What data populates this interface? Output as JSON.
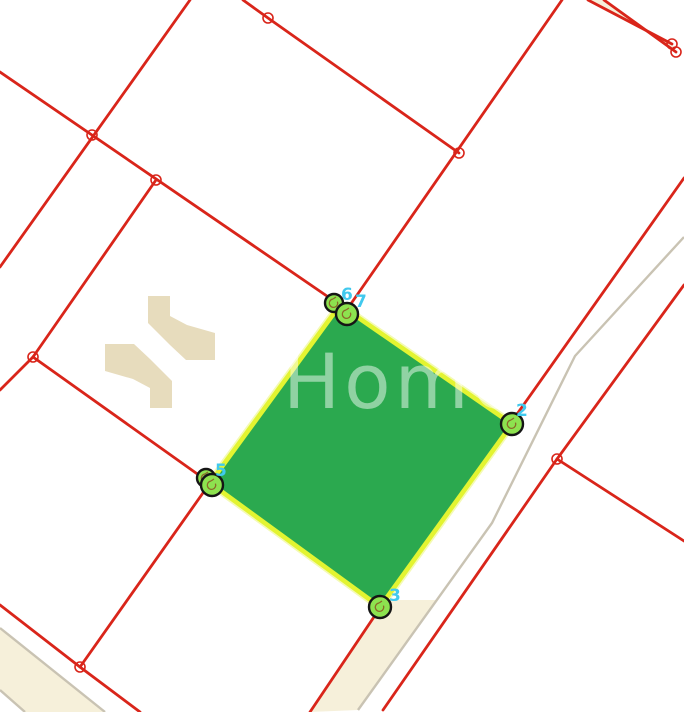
{
  "map": {
    "background": "#ffffff",
    "canvas": {
      "width": 684,
      "height": 712
    },
    "colors": {
      "boundary_red": "#d9251a",
      "road_edge_gray": "#c9c3b3",
      "road_fill_cream": "#f6f0da",
      "parcel_fill_green": "#2ba94f",
      "parcel_stroke_yellow": "#e3f431",
      "parcel_stroke_halo": "#f4fab4",
      "marker_fill_green": "#8de24f",
      "marker_stroke_black": "#151515",
      "marker_glyph_brown": "#8a6a28",
      "vertex_label_cyan": "#41c9ee",
      "junction_ring_red": "#d9251a",
      "logo_beige": "#e7dcbd",
      "watermark_white": "rgba(255,255,255,0.48)"
    },
    "watermark": {
      "text": "Home",
      "x": 283,
      "baseline_y": 408,
      "font_size": 76,
      "letter_spacing": 4
    },
    "logo_shapes": [
      [
        [
          148,
          296
        ],
        [
          170,
          296
        ],
        [
          170,
          316
        ],
        [
          187,
          325
        ],
        [
          215,
          333
        ],
        [
          215,
          360
        ],
        [
          186,
          360
        ],
        [
          170,
          345
        ],
        [
          148,
          323
        ]
      ],
      [
        [
          172,
          408
        ],
        [
          150,
          408
        ],
        [
          150,
          388
        ],
        [
          133,
          379
        ],
        [
          105,
          371
        ],
        [
          105,
          344
        ],
        [
          134,
          344
        ],
        [
          150,
          359
        ],
        [
          172,
          381
        ]
      ]
    ],
    "road_fills": [
      {
        "name": "main-road-surface",
        "points": [
          [
            385,
            600
          ],
          [
            437,
            600
          ],
          [
            358,
            710
          ],
          [
            310,
            712
          ]
        ]
      },
      {
        "name": "topright-road-surface",
        "points": [
          [
            588,
            0
          ],
          [
            604,
            0
          ],
          [
            676,
            52
          ],
          [
            672,
            44
          ]
        ]
      },
      {
        "name": "bottomleft-road-surface",
        "points": [
          [
            0,
            628
          ],
          [
            105,
            712
          ],
          [
            25,
            712
          ],
          [
            0,
            690
          ]
        ]
      }
    ],
    "gray_lines": [
      {
        "name": "main-road-centerline",
        "points": [
          [
            684,
            237
          ],
          [
            575,
            356
          ],
          [
            492,
            523
          ],
          [
            358,
            710
          ]
        ]
      },
      {
        "name": "bottomleft-road-edge-1",
        "points": [
          [
            0,
            628
          ],
          [
            105,
            712
          ]
        ]
      },
      {
        "name": "bottomleft-road-edge-2",
        "points": [
          [
            0,
            690
          ],
          [
            25,
            712
          ]
        ]
      }
    ],
    "red_lines": [
      {
        "name": "boundary-nw-long",
        "points": [
          [
            0,
            72
          ],
          [
            340,
            305
          ]
        ]
      },
      {
        "name": "boundary-topleft-steep",
        "points": [
          [
            190,
            0
          ],
          [
            0,
            267
          ]
        ]
      },
      {
        "name": "boundary-j2-j3",
        "points": [
          [
            156,
            180
          ],
          [
            33,
            357
          ]
        ]
      },
      {
        "name": "boundary-j3-west",
        "points": [
          [
            33,
            357
          ],
          [
            0,
            390
          ]
        ]
      },
      {
        "name": "boundary-j3-v5",
        "points": [
          [
            33,
            357
          ],
          [
            210,
            483
          ]
        ]
      },
      {
        "name": "boundary-v5-j6",
        "points": [
          [
            210,
            483
          ],
          [
            80,
            667
          ]
        ]
      },
      {
        "name": "boundary-bottomleft-road",
        "points": [
          [
            0,
            605
          ],
          [
            80,
            667
          ],
          [
            140,
            712
          ]
        ]
      },
      {
        "name": "boundary-top-d",
        "points": [
          [
            243,
            0
          ],
          [
            268,
            18
          ],
          [
            459,
            153
          ]
        ]
      },
      {
        "name": "boundary-ne-long",
        "points": [
          [
            562,
            0
          ],
          [
            348,
            308
          ]
        ]
      },
      {
        "name": "road-left-boundary",
        "points": [
          [
            684,
            178
          ],
          [
            510,
            424
          ],
          [
            382,
            605
          ],
          [
            310,
            712
          ]
        ]
      },
      {
        "name": "road-right-boundary",
        "points": [
          [
            684,
            285
          ],
          [
            557,
            459
          ],
          [
            383,
            710
          ]
        ]
      },
      {
        "name": "branch-southeast",
        "points": [
          [
            557,
            459
          ],
          [
            684,
            541
          ]
        ]
      },
      {
        "name": "topright-road-edge-upper",
        "points": [
          [
            588,
            0
          ],
          [
            672,
            44
          ]
        ]
      },
      {
        "name": "topright-road-edge-lower",
        "points": [
          [
            604,
            0
          ],
          [
            676,
            52
          ]
        ]
      }
    ],
    "junction_rings": [
      [
        92,
        135
      ],
      [
        156,
        180
      ],
      [
        33,
        357
      ],
      [
        268,
        18
      ],
      [
        459,
        153
      ],
      [
        672,
        44
      ],
      [
        676,
        52
      ],
      [
        557,
        459
      ],
      [
        80,
        667
      ]
    ],
    "parcel": {
      "points": [
        [
          340,
          305
        ],
        [
          512,
          424
        ],
        [
          380,
          607
        ],
        [
          210,
          483
        ]
      ],
      "vertex_markers": [
        {
          "x": 334,
          "y": 303,
          "r": 9
        },
        {
          "x": 347,
          "y": 314,
          "r": 11
        },
        {
          "x": 512,
          "y": 424,
          "r": 11
        },
        {
          "x": 380,
          "y": 607,
          "r": 11
        },
        {
          "x": 206,
          "y": 478,
          "r": 9
        },
        {
          "x": 212,
          "y": 485,
          "r": 11
        }
      ],
      "vertex_labels": [
        {
          "text": "6",
          "x": 341,
          "y": 300
        },
        {
          "text": "7",
          "x": 355,
          "y": 307
        },
        {
          "text": "2",
          "x": 516,
          "y": 416
        },
        {
          "text": "3",
          "x": 389,
          "y": 601
        },
        {
          "text": "5",
          "x": 215,
          "y": 476
        }
      ]
    }
  }
}
